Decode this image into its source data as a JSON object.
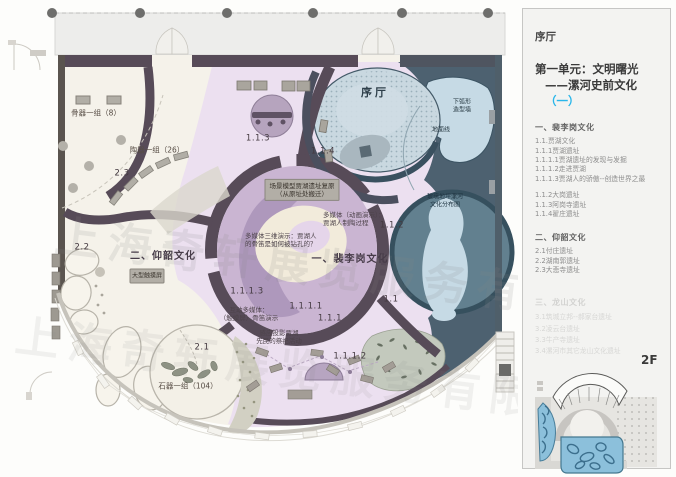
{
  "plan": {
    "watermark": "上海奇轩展览服务有限公司",
    "rooms": {
      "bone_group": "骨器一组（8）",
      "pottery_group": "陶器一组（26）",
      "stone_group": "石器一组（104）",
      "prologue": "序厅",
      "unit_peiligang": "一、裴李岗文化",
      "unit_yangshao": "二、仰韶文化"
    },
    "zones": {
      "z23": "2.3",
      "z22": "2.2",
      "z21": "2.1",
      "z113": "1.1.3",
      "z114": "1.1.4",
      "z112": "1.1.2",
      "z1113": "1.1.1.3",
      "z1111": "1.1.1.1",
      "z111": "1.1.1",
      "z1112": "1.1.1.2",
      "z11": "1.1"
    },
    "notes": {
      "scene_model_1": "场景模型贾湖遗址复原",
      "scene_model_2": "（从原址处搬迁）",
      "mm_anim_1": "多媒体（动画演示）：",
      "mm_anim_2": "贾湖人制陶过程",
      "mm_3d_1": "多媒体三维演示：贾湖人",
      "mm_3d_2": "的骨笛是如何被钻孔的？",
      "interactive_1": "互动多媒体：",
      "interactive_2": "（触摸屏）骨笛演示",
      "projection_1": "感应投影贾湖",
      "projection_2": "先民的祭祀活动",
      "touchscreen": "大型触摸屏",
      "arc_wall_1": "下弧形",
      "arc_wall_2": "造型墙",
      "ground_line": "地面线",
      "glass_floor_1": "玻璃地坪漯河",
      "glass_floor_2": "文化分布图"
    }
  },
  "panel": {
    "prologue": "序厅",
    "unit_title": "第一单元：文明曙光",
    "subtitle_prefix": "——漯河史前文化",
    "subtitle_accent": "（一）",
    "floor_label": "2F",
    "sections": [
      {
        "title": "一、裴李岗文化",
        "items": [
          "1.1.贾湖文化",
          "1.1.1贾湖遗址",
          "1.1.1.1贾湖遗址的发现与发掘",
          "1.1.1.2走进贾湖",
          "1.1.1.3贾湖人的骄傲--创造世界之最",
          "1.1.2大岗遗址",
          "1.1.3阿岗寺遗址",
          "1.1.4翟庄遗址"
        ]
      },
      {
        "title": "二、仰韶文化",
        "items": [
          "2.1付庄遗址",
          "2.2湖南郭遗址",
          "2.3大悲寺遗址"
        ]
      },
      {
        "title": "三、龙山文化",
        "items": [
          "3.1筑城立邦--郝家台遗址",
          "3.2凌云台遗址",
          "3.3牛产寺遗址",
          "3.4漯河市其它龙山文化遗址"
        ]
      }
    ]
  },
  "colors": {
    "accent_cyan": "#29b6ea",
    "wall_dark": "#574b58",
    "zone_pink": "#ece0f0",
    "zone_cream": "#f5f2ea",
    "zone_blue_dark": "#4d6170",
    "zone_blue_light": "#c6dae5",
    "minimap_highlight": "#8cc0db"
  }
}
